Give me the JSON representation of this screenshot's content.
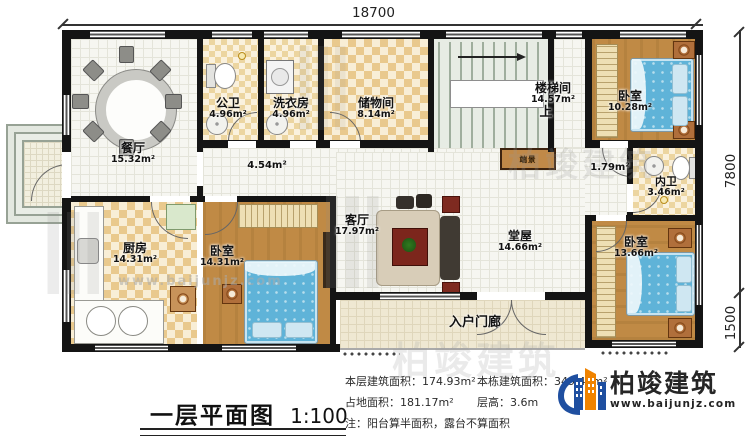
{
  "title": {
    "text": "一层平面图",
    "scale": "1:100"
  },
  "dimensions": {
    "width": "18700",
    "depth_main": "7800",
    "depth_porch": "1500"
  },
  "rooms": {
    "dining": {
      "name": "餐厅",
      "area": "15.32m²"
    },
    "public_bath": {
      "name": "公卫",
      "area": "4.96m²"
    },
    "laundry": {
      "name": "洗衣房",
      "area": "4.96m²"
    },
    "storage": {
      "name": "储物间",
      "area": "8.14m²"
    },
    "stairwell": {
      "name": "楼梯间",
      "area": "14.57m²"
    },
    "bedroom_ne": {
      "name": "卧室",
      "area": "10.28m²"
    },
    "inner_bath": {
      "name": "内卫",
      "area": "3.46m²"
    },
    "hallway": {
      "name": "",
      "area": "1.79m²"
    },
    "corridor": {
      "name": "",
      "area": "4.54m²"
    },
    "living": {
      "name": "客厅",
      "area": "17.97m²"
    },
    "main_hall": {
      "name": "堂屋",
      "area": "14.66m²"
    },
    "bedroom_se": {
      "name": "卧室",
      "area": "13.66m²"
    },
    "kitchen": {
      "name": "厨房",
      "area": "14.31m²"
    },
    "bedroom_s": {
      "name": "卧室",
      "area": "14.31m²"
    },
    "porch": {
      "name": "入户门廊",
      "area": ""
    }
  },
  "plan_labels": {
    "up": "上",
    "end_view": "端景"
  },
  "info": {
    "floor_area_label": "本层建筑面积：",
    "floor_area_value": "174.93m²",
    "building_area_label": "本栋建筑面积：",
    "building_area_value": "349.43m²",
    "land_area_label": "占地面积：",
    "land_area_value": "181.17m²",
    "height_label": "层高：",
    "height_value": "3.6m",
    "note": "注：阳台算半面积，露台不算面积"
  },
  "brand": {
    "name": "柏竣建筑",
    "site": "www.baijunjz.com"
  },
  "watermark": {
    "brand_text": "柏竣建筑",
    "site_text": "www.baijunjz.com"
  },
  "colors": {
    "wall": "#141414",
    "accent_blue": "#1f4fa0",
    "accent_orange": "#f08300",
    "bed_blue": "#5fb3d8",
    "wood": "#b5823f",
    "checker": "#e9c98d"
  }
}
